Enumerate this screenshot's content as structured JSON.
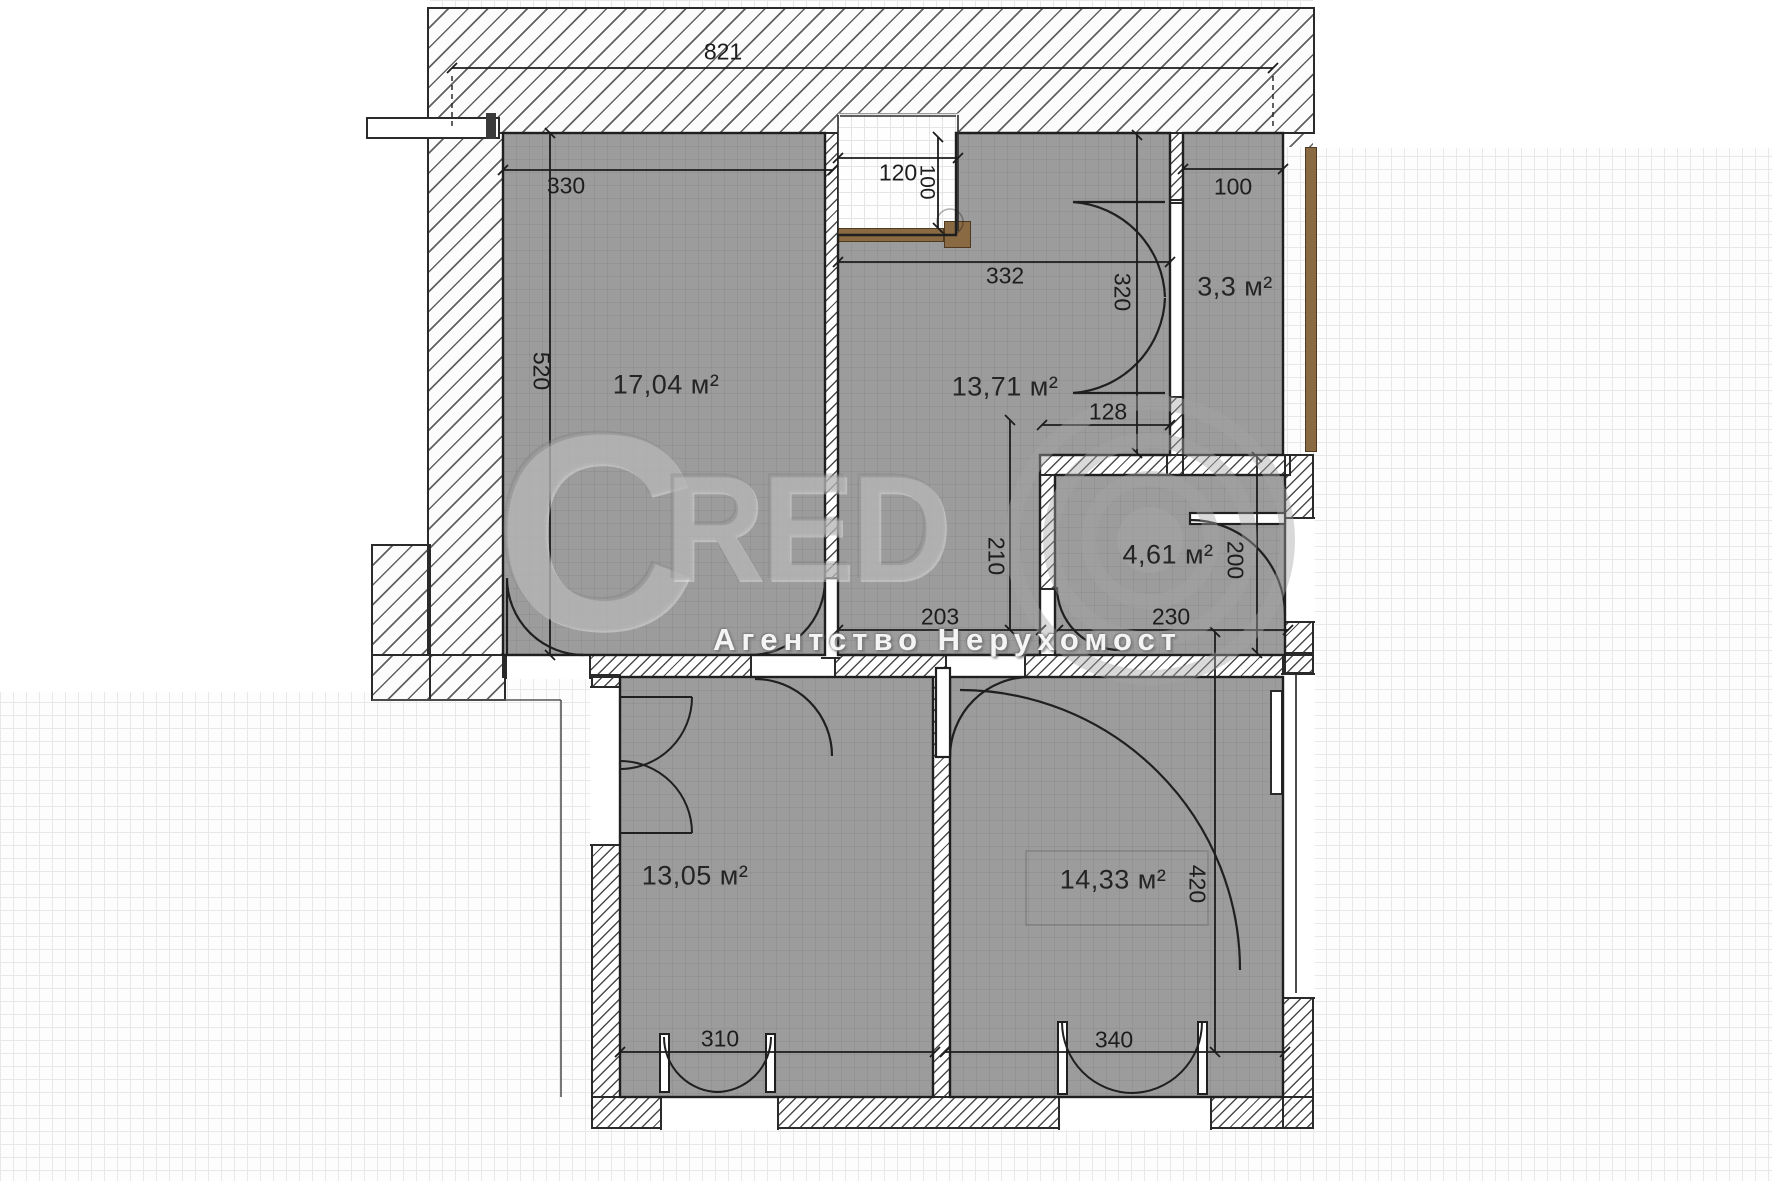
{
  "rooms": {
    "living": "17,04 м²",
    "hall": "13,71 м²",
    "storage": "3,3 м²",
    "bath": "4,61 м²",
    "bedroom1": "13,05 м²",
    "bedroom2": "14,33 м²"
  },
  "dims": {
    "overall_width": "821",
    "living_width": "330",
    "living_height": "520",
    "entry_niche_width": "120",
    "entry_niche_depth": "100",
    "hall_width": "332",
    "storage_door_height": "320",
    "storage_width": "100",
    "bath_pass_width": "128",
    "hall_lower_depth": "210",
    "hall_lower_width": "203",
    "bath_width": "230",
    "bath_door_height": "200",
    "bedroom1_window_width": "310",
    "bedroom2_window_width": "340",
    "bedroom2_height": "420"
  },
  "watermark": {
    "letter_c": "C",
    "letters_red": "RED",
    "subtitle": "Агентство Нерухомост"
  },
  "colors": {
    "room_fill": "#9c9c9c",
    "wall_line": "#1f1f1f",
    "wood": "#8a6a42"
  }
}
